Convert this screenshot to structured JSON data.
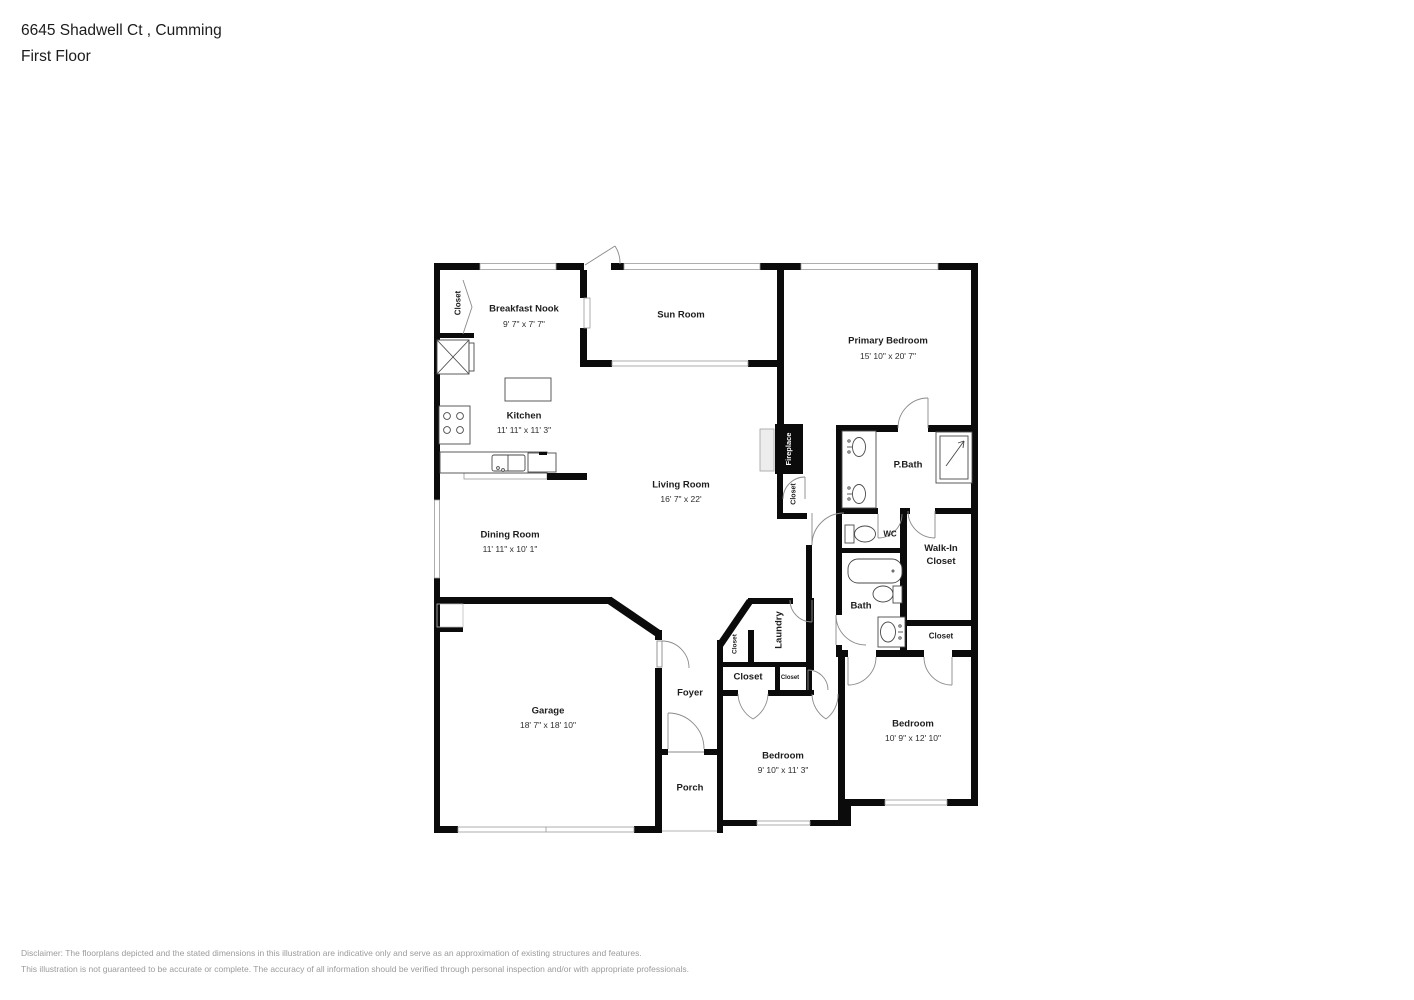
{
  "header": {
    "address": "6645 Shadwell Ct , Cumming",
    "floor": "First Floor"
  },
  "rooms": {
    "closet_entry": {
      "label": "Closet"
    },
    "breakfast_nook": {
      "label": "Breakfast Nook",
      "dims": "9' 7\" x 7' 7\""
    },
    "sun_room": {
      "label": "Sun Room"
    },
    "primary_bedroom": {
      "label": "Primary Bedroom",
      "dims": "15' 10\" x 20' 7\""
    },
    "kitchen": {
      "label": "Kitchen",
      "dims": "11' 11\" x 11' 3\""
    },
    "living_room": {
      "label": "Living Room",
      "dims": "16' 7\" x 22'"
    },
    "dining_room": {
      "label": "Dining Room",
      "dims": "11' 11\" x 10' 1\""
    },
    "fireplace": {
      "label": "Fireplace"
    },
    "closet_hall": {
      "label": "Closet"
    },
    "p_bath": {
      "label": "P.Bath"
    },
    "wc": {
      "label": "WC"
    },
    "walk_in_closet": {
      "label": "Walk-In Closet"
    },
    "bath": {
      "label": "Bath"
    },
    "closet_suite": {
      "label": "Closet"
    },
    "laundry": {
      "label": "Laundry"
    },
    "closet_laundry": {
      "label": "Closet"
    },
    "closet_bedroom_left": {
      "label": "Closet"
    },
    "closet_bedroom_right": {
      "label": "Closet"
    },
    "foyer": {
      "label": "Foyer"
    },
    "garage": {
      "label": "Garage",
      "dims": "18' 7\" x 18' 10\""
    },
    "bedroom_middle": {
      "label": "Bedroom",
      "dims": "9' 10\" x 11' 3\""
    },
    "bedroom_right": {
      "label": "Bedroom",
      "dims": "10' 9\" x 12' 10\""
    },
    "porch": {
      "label": "Porch"
    }
  },
  "colors": {
    "wall": "#0b0b0b",
    "window_stroke": "#9a9a9a",
    "door_stroke": "#8a8a8a",
    "fixture_stroke": "#4a4a4a",
    "disclaimer_text": "#9b9b9b"
  },
  "disclaimer": {
    "line1": "Disclaimer: The floorplans depicted and the stated dimensions in this illustration are indicative only and serve as an approximation of existing structures and features.",
    "line2": "This illustration is not guaranteed to be accurate or complete. The accuracy of all information should be verified through personal inspection and/or with appropriate professionals."
  }
}
